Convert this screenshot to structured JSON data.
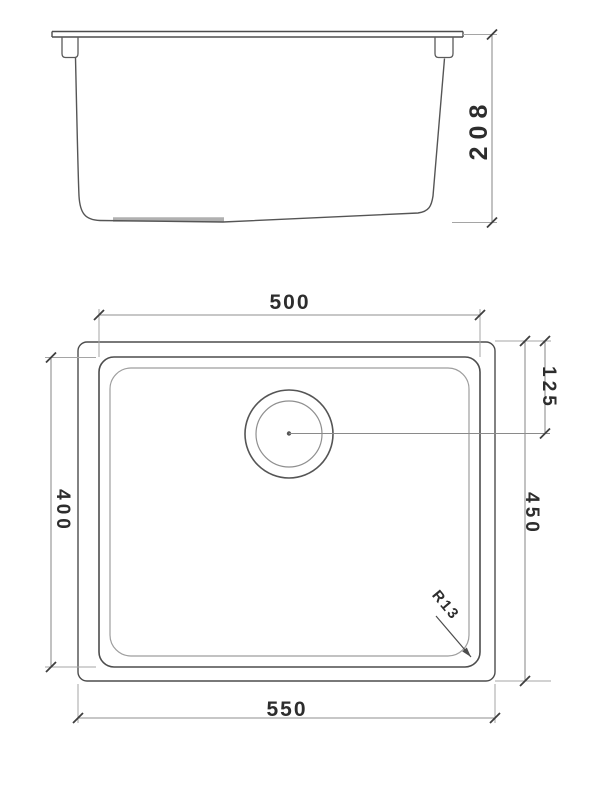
{
  "drawing": {
    "type": "sink-technical-drawing",
    "background": "#ffffff",
    "views": {
      "front": {
        "name": "front-elevation-view",
        "dims": {
          "height": "208"
        }
      },
      "plan": {
        "name": "plan-top-view",
        "dims": {
          "bowl_width": "500",
          "drain_offset": "125",
          "bowl_depth": "400",
          "overall_depth": "450",
          "overall_width": "550",
          "corner_radius": "R13"
        }
      }
    },
    "colors": {
      "outline": "#4d4d4d",
      "light_line": "#a5a5a5",
      "dim_line": "#8f8f8f",
      "tick": "#3f3f3f",
      "text": "#2d2d2d",
      "pad": "#b0b0b0"
    }
  }
}
